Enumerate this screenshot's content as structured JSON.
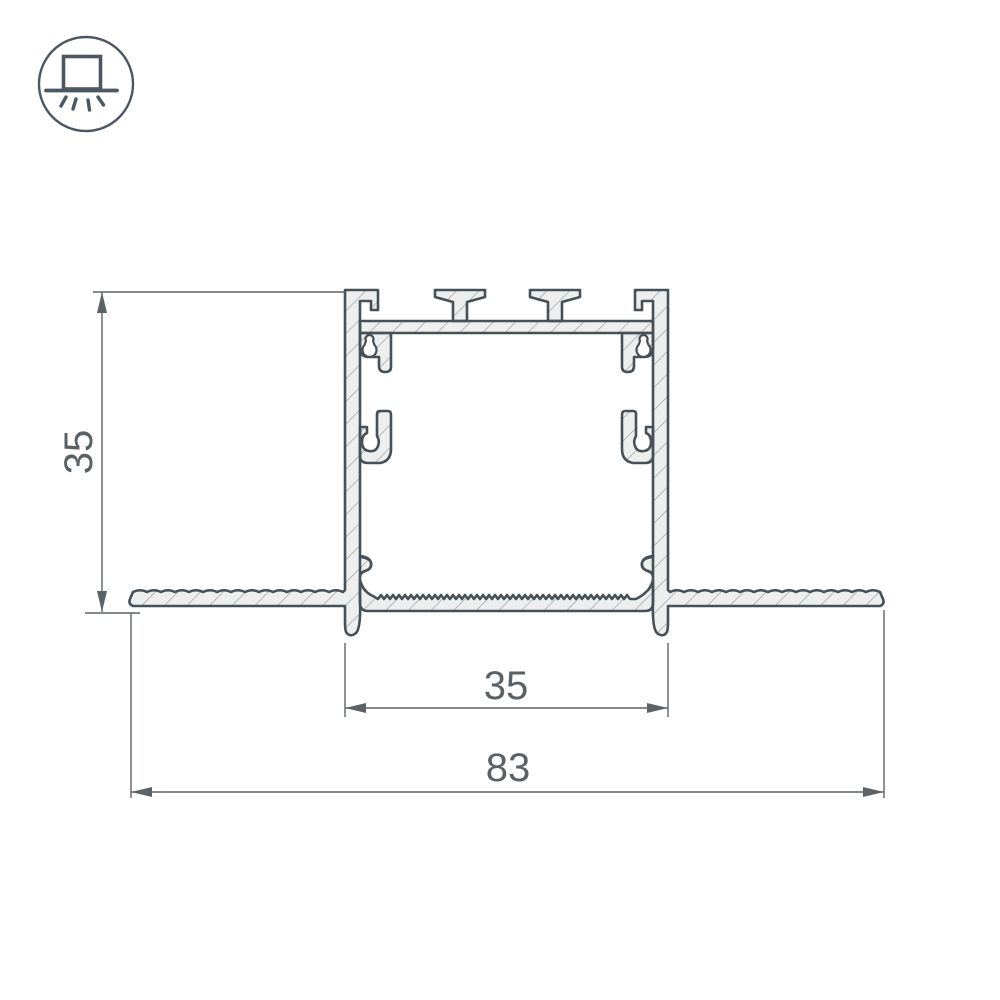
{
  "icon": {
    "name": "recessed-light-icon"
  },
  "dimensions": {
    "height": "35",
    "inner_width": "35",
    "overall_width": "83"
  },
  "colors": {
    "profile_outline": "#475056",
    "profile_fill": "#edefef",
    "hatch_line": "#9aa1a5",
    "dimension_line": "#5c6367",
    "dimension_text": "#5a6165",
    "background": "#ffffff"
  }
}
